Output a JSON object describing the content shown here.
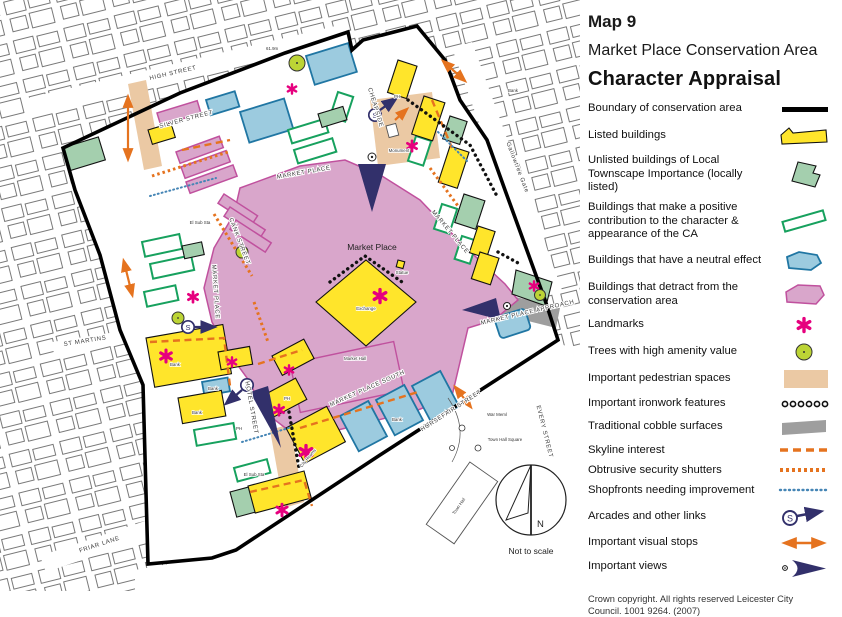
{
  "title": {
    "map_no": "Map 9",
    "area": "Market Place Conservation Area",
    "subtitle": "Character Appraisal"
  },
  "legend": {
    "items": [
      {
        "id": "boundary",
        "label": "Boundary of conservation area"
      },
      {
        "id": "listed",
        "label": "Listed buildings"
      },
      {
        "id": "unlisted",
        "label": "Unlisted buildings of Local Townscape Importance (locally listed)"
      },
      {
        "id": "positive",
        "label": "Buildings that make a positive contribution to the character & appearance of the CA"
      },
      {
        "id": "neutral",
        "label": "Buildings that have a neutral effect"
      },
      {
        "id": "detract",
        "label": "Buildings that detract from the conservation area"
      },
      {
        "id": "landmarks",
        "label": "Landmarks"
      },
      {
        "id": "trees",
        "label": "Trees with high amenity value"
      },
      {
        "id": "pedestrian",
        "label": "Important pedestrian spaces"
      },
      {
        "id": "ironwork",
        "label": "Important ironwork features"
      },
      {
        "id": "cobble",
        "label": "Traditional cobble surfaces"
      },
      {
        "id": "skyline",
        "label": "Skyline interest"
      },
      {
        "id": "shutters",
        "label": "Obtrusive security shutters"
      },
      {
        "id": "shopfronts",
        "label": "Shopfronts needing improvement"
      },
      {
        "id": "arcades",
        "label": "Arcades and other links"
      },
      {
        "id": "visual_stops",
        "label": "Important visual stops"
      },
      {
        "id": "views",
        "label": "Important views"
      }
    ],
    "arcade_symbol_letter": "S"
  },
  "copyright": "Crown copyright. All rights reserved Leicester City Council. 1001 9264. (2007)",
  "map": {
    "labels": {
      "high_street": "HIGH STREET",
      "silver_street": "SILVER STREET",
      "cheapside": "CHEAPSIDE",
      "cank_street": "CANK STREET",
      "st_martins": "ST MARTINS",
      "market_place_street": "MARKET PLACE",
      "gallowtree_gate": "Gallowtree Gate",
      "market_place_approach": "MARKET PLACE APPROACH",
      "market_place_south": "MARKET PLACE SOUTH",
      "hotel_street": "HOTEL STREET",
      "horsefair_street": "HORSEFAIR STREET",
      "every_street": "EVERY STREET",
      "friar_lane": "FRIAR LANE",
      "market_place": "Market Place",
      "market_hall": "Market Hall",
      "exchange": "Exchange",
      "city_rooms": "City Rooms",
      "statue": "Statue",
      "monument": "Monument",
      "town_hall": "Town Hall",
      "town_hall_square": "Town Hall Square",
      "war_meml": "War Meml",
      "el_sub_sta": "El Sub Sta",
      "bank": "Bank",
      "ph": "PH",
      "spot_height": "61.9m",
      "not_to_scale": "Not to scale",
      "north": "N"
    }
  },
  "colors": {
    "boundary": "#000000",
    "listed": "#FFE52B",
    "locally_listed": "#A4CFAE",
    "positive": "#17A15E",
    "neutral_fill": "#9CCBDF",
    "neutral_stroke": "#2076A3",
    "detract_fill": "#D9A6CB",
    "detract_stroke": "#C0519E",
    "landmark": "#E6007E",
    "tree": "#BCD435",
    "pedestrian": "#EBC9A4",
    "cobble": "#9E9E9E",
    "orange": "#E5731F",
    "navy": "#32306B",
    "shopfront_blue": "#4585B5"
  }
}
